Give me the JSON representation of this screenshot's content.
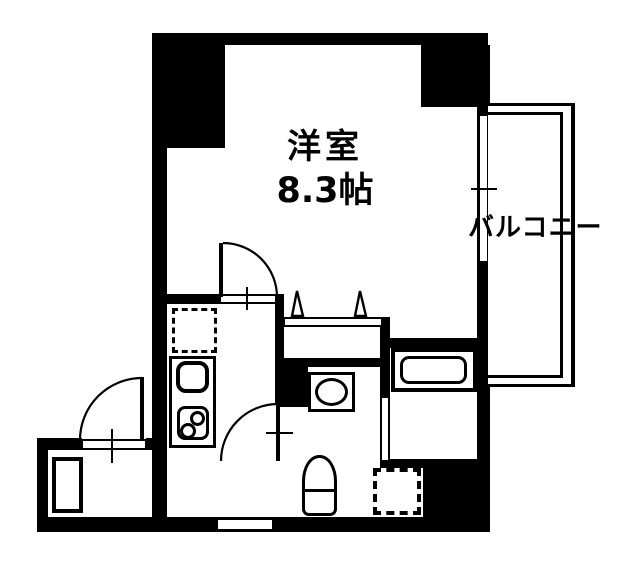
{
  "page": {
    "type": "apartment-floorplan",
    "background_color": "#ffffff",
    "wall_color": "#000000"
  },
  "labels": {
    "main_room": "洋室",
    "main_room_size": "8.3帖",
    "balcony": "バルコニー"
  }
}
